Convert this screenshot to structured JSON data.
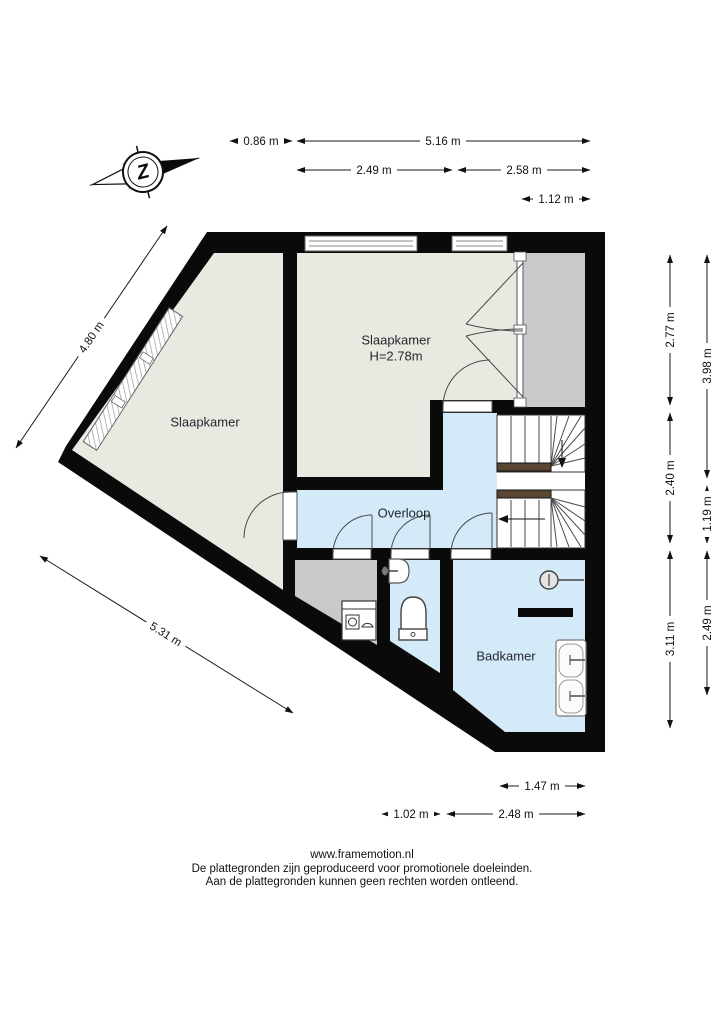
{
  "compass": {
    "letter": "Z"
  },
  "rooms": {
    "bedroom_main": {
      "name": "Slaapkamer",
      "ceiling_height": "H=2.78m"
    },
    "bedroom_left": {
      "name": "Slaapkamer"
    },
    "landing": {
      "name": "Overloop"
    },
    "bathroom": {
      "name": "Badkamer"
    }
  },
  "dimensions": {
    "top": [
      "0.86 m",
      "5.16 m",
      "2.49 m",
      "2.58 m",
      "1.12 m"
    ],
    "right_inner": [
      "2.77 m",
      "2.40 m",
      "3.11 m"
    ],
    "right_outer": [
      "3.98 m",
      "1.19 m",
      "2.49 m"
    ],
    "bottom": [
      "1.47 m",
      "1.02 m",
      "2.48 m"
    ],
    "diagonal": [
      "4.80 m",
      "5.31 m"
    ]
  },
  "footer": {
    "website": "www.framemotion.nl",
    "disclaimer1": "De plattegronden zijn geproduceerd voor promotionele doeleinden.",
    "disclaimer2": "Aan de plattegronden kunnen geen rechten worden ontleend."
  },
  "colors": {
    "wall": "#0a0a0a",
    "bedroom_floor": "#eae9e1",
    "wet_room_floor": "#d5eaf8",
    "closet_floor": "#c9c9c9",
    "stair_accent": "#5a4733"
  }
}
